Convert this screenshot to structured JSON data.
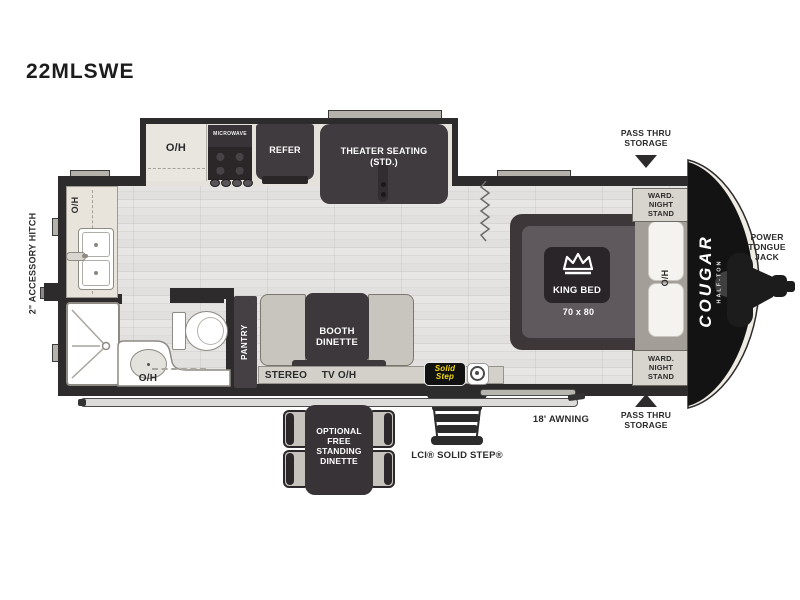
{
  "title": "22MLSWE",
  "colors": {
    "wall": "#2e2b2c",
    "dark_furniture": "#403b3e",
    "floor_gray": "#e1e0de",
    "cabinet_beige": "#e9e6e0",
    "front_cap_black": "#131313",
    "solid_step_yellow": "#f4d812",
    "label_dark": "#2b2b2b"
  },
  "icons": {
    "king_bed": "crown-icon",
    "pass_thru_top": "arrow-down-icon",
    "pass_thru_bottom": "arrow-up-icon",
    "lci_badge": "lci-circle-icon",
    "curtain": "zigzag-curtain",
    "entry_steps": "steps-icon"
  },
  "labels": {
    "kitchen_overhead": "O/H",
    "microwave": "MICROWAVE",
    "refrigerator": "REFER",
    "theater_seating": "THEATER SEATING\n(STD.)",
    "counter_overhead": "O/H",
    "accessory_hitch": "2\" ACCESSORY HITCH",
    "bath_overhead": "O/H",
    "pantry": "PANTRY",
    "booth_dinette": "BOOTH\nDINETTE",
    "stereo": "STEREO",
    "tv_overhead": "TV O/H",
    "king_bed": "KING BED",
    "king_bed_size": "70 x 80",
    "bed_overhead": "O/H",
    "ward_night_stand_top": "WARD.\nNIGHT\nSTAND",
    "ward_night_stand_bottom": "WARD.\nNIGHT\nSTAND",
    "pass_thru_top": "PASS THRU\nSTORAGE",
    "pass_thru_bottom": "PASS THRU\nSTORAGE",
    "power_tongue_jack": "POWER\nTONGUE\nJACK",
    "awning": "18' AWNING",
    "solid_step_caption": "LCI® SOLID STEP®",
    "optional_dinette": "OPTIONAL\nFREE\nSTANDING\nDINETTE",
    "brand": "COUGAR",
    "brand_sub": "HALF-TON",
    "solid_step_logo": "Solid\nStep"
  }
}
